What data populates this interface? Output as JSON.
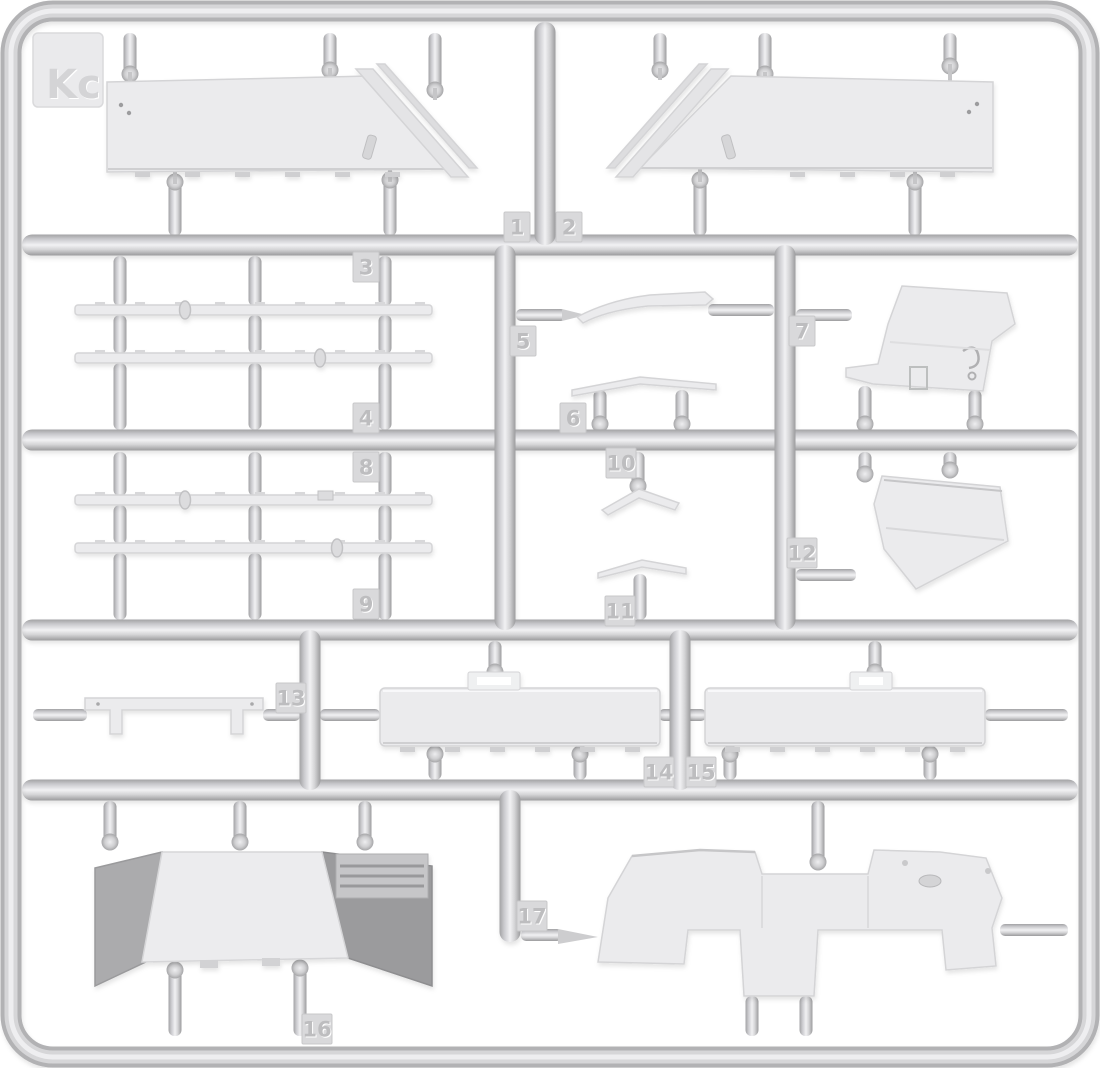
{
  "sprue": {
    "label": "Kc",
    "plastic_color": "#d6d6d8",
    "background_color": "#ffffff",
    "part_tags": [
      {
        "number": "1",
        "x": 517,
        "y": 227
      },
      {
        "number": "2",
        "x": 569,
        "y": 227
      },
      {
        "number": "3",
        "x": 366,
        "y": 267
      },
      {
        "number": "4",
        "x": 366,
        "y": 418
      },
      {
        "number": "5",
        "x": 523,
        "y": 341
      },
      {
        "number": "6",
        "x": 573,
        "y": 418
      },
      {
        "number": "7",
        "x": 802,
        "y": 331
      },
      {
        "number": "8",
        "x": 366,
        "y": 467
      },
      {
        "number": "9",
        "x": 366,
        "y": 604
      },
      {
        "number": "10",
        "x": 621,
        "y": 463
      },
      {
        "number": "11",
        "x": 620,
        "y": 611
      },
      {
        "number": "12",
        "x": 802,
        "y": 553
      },
      {
        "number": "13",
        "x": 291,
        "y": 698
      },
      {
        "number": "14",
        "x": 659,
        "y": 772
      },
      {
        "number": "15",
        "x": 701,
        "y": 772
      },
      {
        "number": "16",
        "x": 317,
        "y": 1029
      },
      {
        "number": "17",
        "x": 532,
        "y": 916
      }
    ]
  }
}
